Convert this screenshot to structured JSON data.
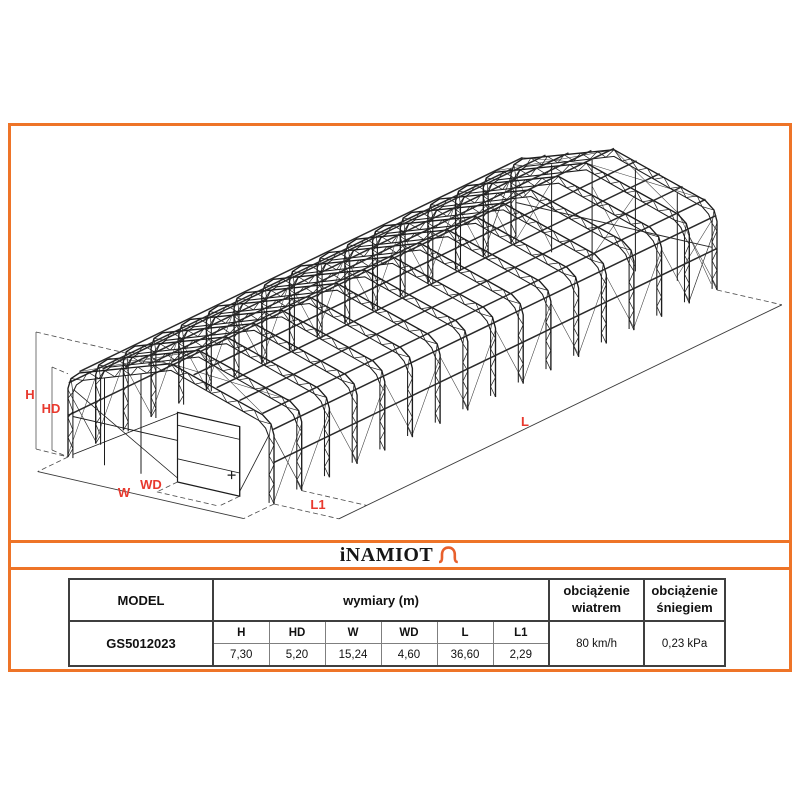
{
  "drawing": {
    "dimension_labels": {
      "h": "H",
      "hd": "HD",
      "w": "W",
      "wd": "WD",
      "l": "L",
      "l1": "L1"
    }
  },
  "logo": {
    "brand": "iNAMIOT",
    "icon": "tent-arch-icon"
  },
  "table": {
    "model_header": "MODEL",
    "dimensions_header": "wymiary (m)",
    "wind_header": "obciążenie wiatrem",
    "snow_header": "obciążenie śniegiem",
    "dim_columns": [
      "H",
      "HD",
      "W",
      "WD",
      "L",
      "L1"
    ],
    "row": {
      "model": "GS5012023",
      "values": [
        "7,30",
        "5,20",
        "15,24",
        "4,60",
        "36,60",
        "2,29"
      ],
      "wind": "80 km/h",
      "snow": "0,23 kPa"
    }
  },
  "colors": {
    "accent_orange": "#EE7428",
    "dimension_label_red": "#E8392E"
  }
}
